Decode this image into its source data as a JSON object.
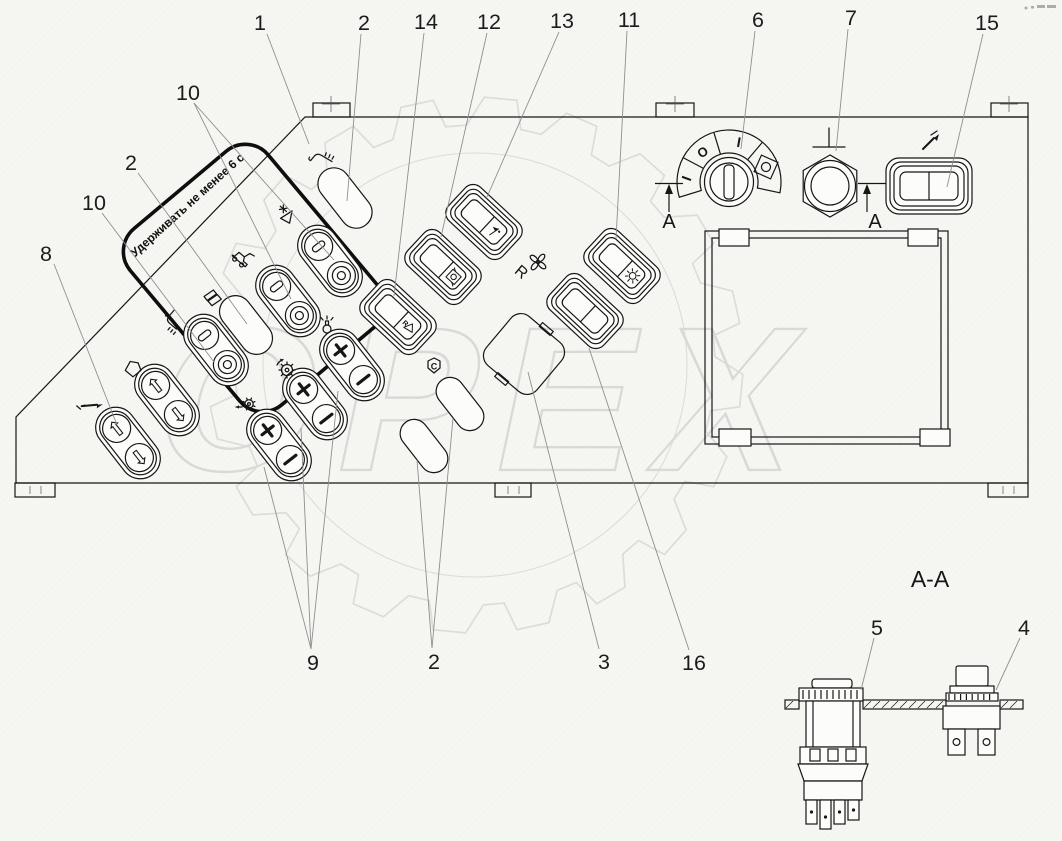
{
  "watermark": {
    "text": "ОРЕХ"
  },
  "panel": {
    "hold_note": "Удерживать не менее 6 с",
    "rotary_dial_positions": [
      "I",
      "O",
      "I"
    ],
    "fan_switch_label": "R",
    "r_switch_letter": "R",
    "shield_letter": "C",
    "section_arrow_letter": "A"
  },
  "section_view": {
    "title": "A-A"
  },
  "callouts": [
    {
      "id": "callout-1",
      "label": "1"
    },
    {
      "id": "callout-2-top",
      "label": "2"
    },
    {
      "id": "callout-14",
      "label": "14"
    },
    {
      "id": "callout-12",
      "label": "12"
    },
    {
      "id": "callout-13",
      "label": "13"
    },
    {
      "id": "callout-11",
      "label": "11"
    },
    {
      "id": "callout-6",
      "label": "6"
    },
    {
      "id": "callout-7",
      "label": "7"
    },
    {
      "id": "callout-15",
      "label": "15"
    },
    {
      "id": "callout-10-upper",
      "label": "10"
    },
    {
      "id": "callout-2-left",
      "label": "2"
    },
    {
      "id": "callout-10-lower",
      "label": "10"
    },
    {
      "id": "callout-8",
      "label": "8"
    },
    {
      "id": "callout-9",
      "label": "9"
    },
    {
      "id": "callout-2-bottom",
      "label": "2"
    },
    {
      "id": "callout-3",
      "label": "3"
    },
    {
      "id": "callout-16",
      "label": "16"
    },
    {
      "id": "callout-5",
      "label": "5"
    },
    {
      "id": "callout-4",
      "label": "4"
    }
  ],
  "icons": [
    "wiper-washer-icon",
    "defrost-triangle-icon",
    "harvester-icon",
    "document-icon",
    "seat-icon",
    "cab-icon",
    "lubrication-icon",
    "beacon-icon",
    "gear-ccw-icon",
    "gear-left-icon",
    "shield-c-icon",
    "fan-icon",
    "sun-icon",
    "box-circle-icon",
    "flag-icon",
    "r-triangle-icon",
    "grease-gun-icon",
    "ground-icon",
    "arrow-up-icon",
    "arrow-down-icon",
    "plus-icon",
    "minus-icon",
    "ring-icon"
  ]
}
